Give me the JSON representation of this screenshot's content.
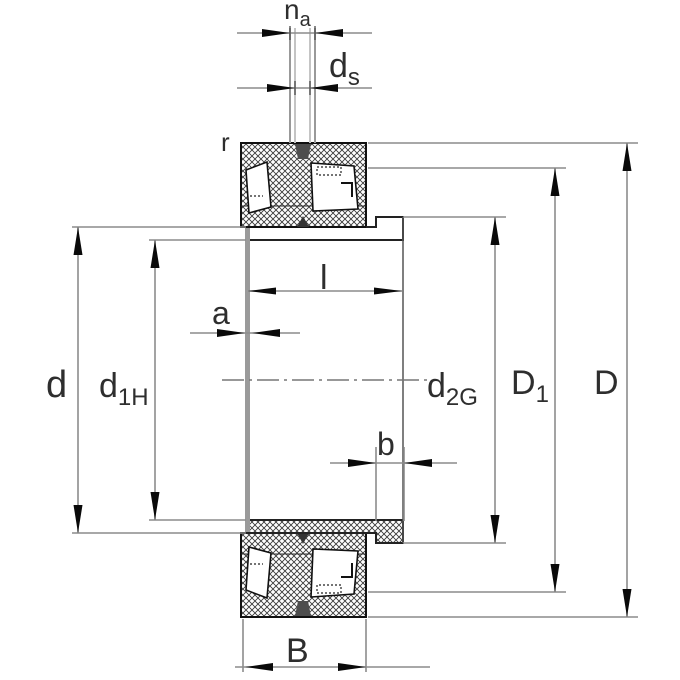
{
  "drawing": {
    "type": "bearing-cross-section-dimension-drawing",
    "labels": {
      "na_main": "n",
      "na_sub": "a",
      "ds_main": "d",
      "ds_sub": "s",
      "r": "r",
      "l": "l",
      "a": "a",
      "d": "d",
      "d1h_main": "d",
      "d1h_sub": "1H",
      "d2g_main": "d",
      "d2g_sub": "2G",
      "D1_main": "D",
      "D1_sub": "1",
      "D": "D",
      "b": "b",
      "B": "B"
    },
    "colors": {
      "background": "#ffffff",
      "outline": "#1a1a1a",
      "dimension_line": "#8c8c8c",
      "hatch": "#3a3a3a",
      "label_text": "#2e2e2e",
      "sleeve_face": "#9a9a9a",
      "arrow": "#0a0a0a"
    }
  }
}
